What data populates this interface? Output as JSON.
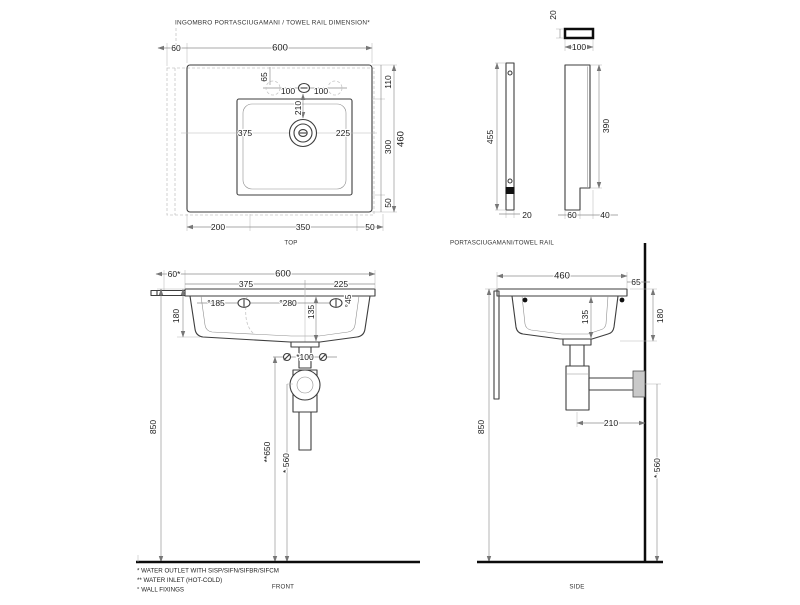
{
  "title": "INGOMBRO PORTASCIUGAMANI / TOWEL RAIL DIMENSION*",
  "views": {
    "top": {
      "label": "TOP",
      "dims": {
        "rail_offset": "60",
        "width_total": "600",
        "tap_to_edge": "65",
        "tap_left": "100",
        "tap_right": "100",
        "tap_to_drain": "210",
        "edge_to_bowl": "110",
        "drain_from_left": "375",
        "drain_from_right": "225",
        "bowl_depth": "300",
        "depth_total": "460",
        "bowl_to_front": "50",
        "bottom_left": "200",
        "bottom_mid": "350",
        "bottom_right": "50"
      }
    },
    "towel_rail": {
      "label": "PORTASCIUGAMANI/TOWEL RAIL",
      "dims": {
        "bar_thickness_top": "20",
        "bar_section_width": "100",
        "bar_length": "455",
        "bar_thickness_bottom": "20",
        "bracket_length": "390",
        "bracket_foot": "60",
        "bracket_notch": "40"
      }
    },
    "front": {
      "label": "FRONT",
      "dims": {
        "rail_offset": "60*",
        "width_total": "600",
        "drain_from_left": "375",
        "drain_from_right": "225",
        "fix_left": "°185",
        "fix_spacing": "°280",
        "bowl_depth": "135",
        "fix_diameter": "°45",
        "apron_height": "180",
        "rim_height": "850",
        "inlet_spacing": "*100",
        "inlet_height": "**650",
        "outlet_height": "* 560"
      }
    },
    "side": {
      "label": "SIDE",
      "dims": {
        "depth_total": "460",
        "back_gap": "65",
        "bowl_depth": "135",
        "apron_height": "180",
        "rim_height": "850",
        "trap_to_wall": "210",
        "outlet_height": "* 560"
      }
    }
  },
  "footnotes": {
    "outlet": "* WATER OUTLET WITH SISP/SIFN/SIFBR/SIFCM",
    "inlet": "** WATER INLET (HOT-COLD)",
    "fixings": "° WALL FIXINGS"
  }
}
